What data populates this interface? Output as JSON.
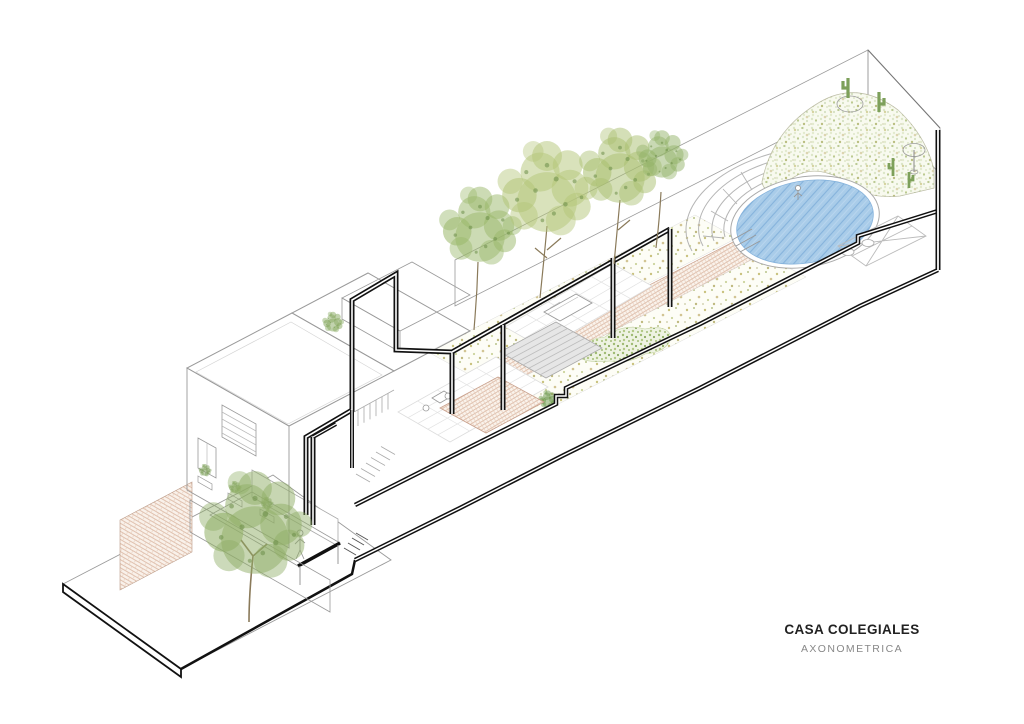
{
  "title_block": {
    "title": "CASA COLEGIALES",
    "subtitle": "AXONOMETRICA"
  },
  "colors": {
    "ink": "#111111",
    "outline_gray": "#9a9a9a",
    "brick_line": "#d8b29c",
    "brick_bg": "#faf3ec",
    "lattice_line": "#c9a285",
    "gravel_bg": "#fdfdf6",
    "pool_fill": "#a9cce9",
    "pool_line": "#86b3dc",
    "roof_gray": "#d0d0d0",
    "deck_gray": "#e6e6e6",
    "tree_green_1": "#9ab86a",
    "tree_green_2": "#b3c578",
    "tree_green_3": "#8fae65",
    "cactus_green": "#7da05a",
    "groundcover_bg": "#eef3e2",
    "title_color": "#222222",
    "subtitle_color": "#888888"
  }
}
